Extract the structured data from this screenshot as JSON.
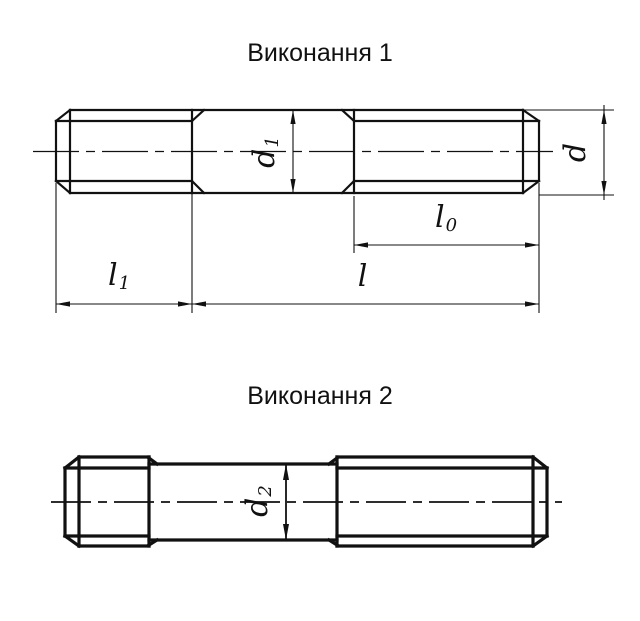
{
  "titles": {
    "execution1": "Виконання 1",
    "execution2": "Виконання 2"
  },
  "dimension_labels": {
    "d": {
      "base": "d",
      "sub": ""
    },
    "d1": {
      "base": "d",
      "sub": "1"
    },
    "d2": {
      "base": "d",
      "sub": "2"
    },
    "l": {
      "base": "l",
      "sub": ""
    },
    "l0": {
      "base": "l",
      "sub": "0"
    },
    "l1": {
      "base": "l",
      "sub": "1"
    }
  },
  "colors": {
    "line": "#111111",
    "background": "#ffffff"
  }
}
